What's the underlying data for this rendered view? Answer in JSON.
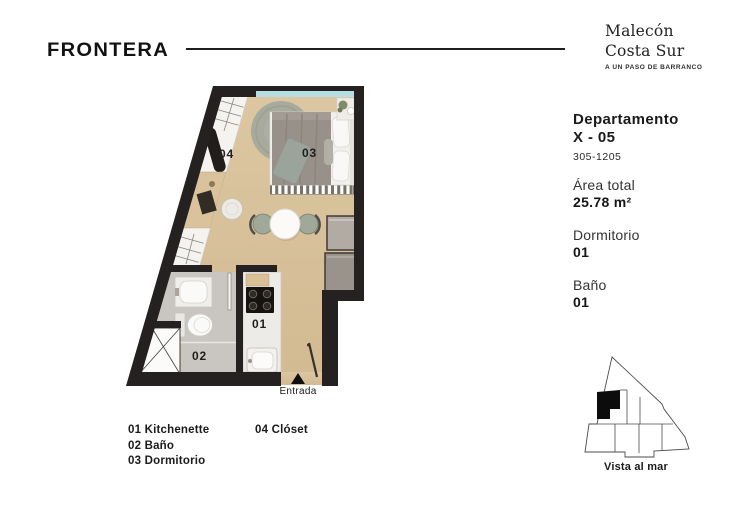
{
  "header": {
    "logo": "FRONTERA",
    "project_line1": "Malecón",
    "project_line2": "Costa Sur",
    "tagline": "A UN PASO DE BARRANCO"
  },
  "info": {
    "title_line1": "Departamento",
    "title_line2": "X - 05",
    "units_range": "305-1205",
    "area_label": "Área total",
    "area_value": "25.78 m²",
    "bedrooms_label": "Dormitorio",
    "bedrooms_value": "01",
    "bathrooms_label": "Baño",
    "bathrooms_value": "01"
  },
  "floorplan": {
    "label_kitchenette": "01",
    "label_bano": "02",
    "label_dormitorio": "03",
    "label_closet": "04",
    "entrance": "Entrada"
  },
  "legend": {
    "items": [
      "01 Kitchenette",
      "02 Baño",
      "03 Dormitorio",
      "04 Clóset"
    ]
  },
  "locator": {
    "caption": "Vista al mar"
  },
  "colors": {
    "wall": "#242120",
    "wood_floor": "#d7c099",
    "bath_floor": "#c9c6c1",
    "window_blue": "#b8dde3",
    "rug_green": "#a7aa9d",
    "blanket_gray": "#98918a",
    "text_dark": "#1d1d1d"
  }
}
